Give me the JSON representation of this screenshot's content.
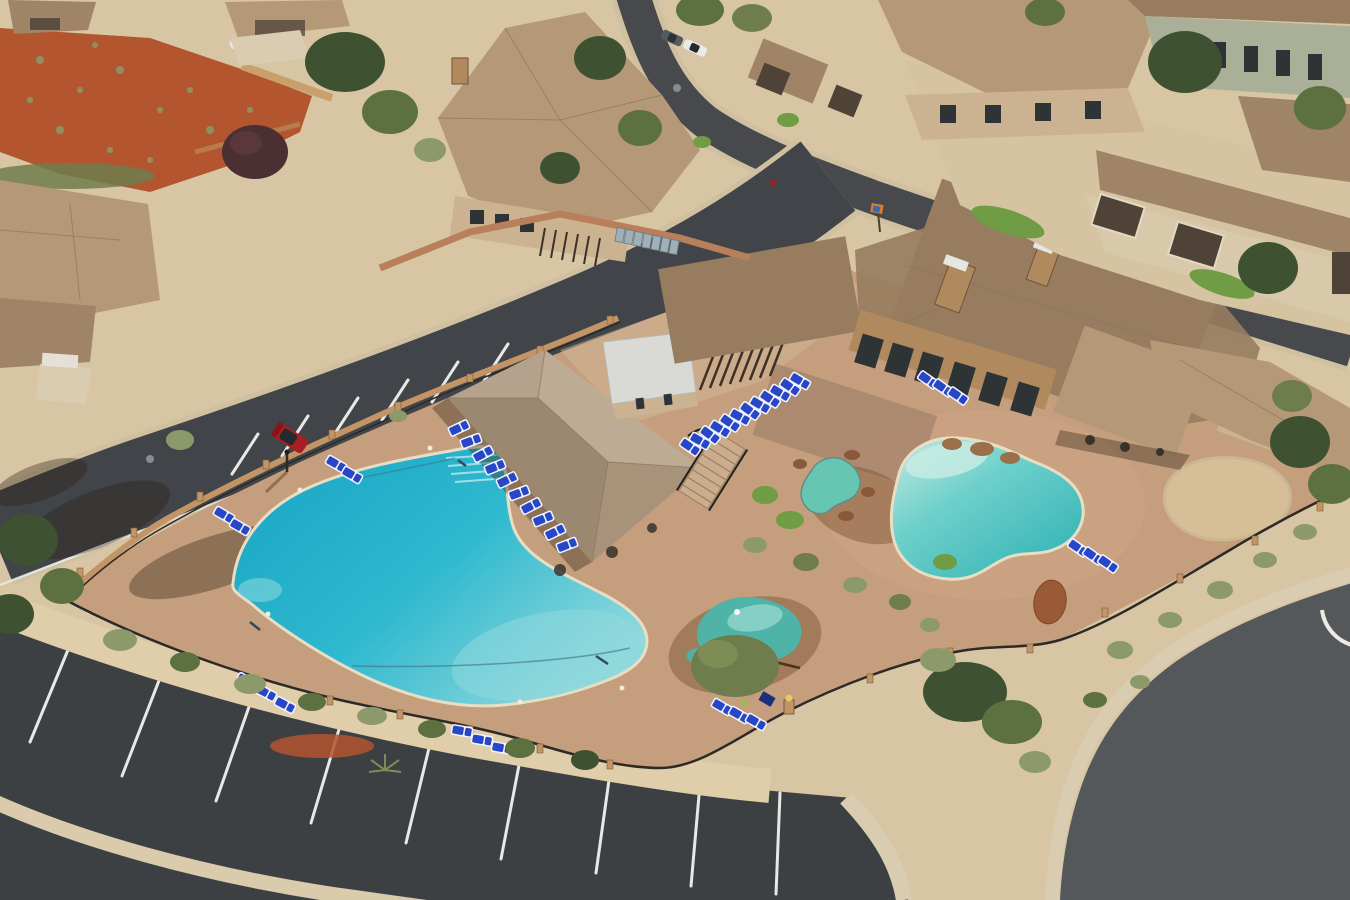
{
  "scene": {
    "title": "Aerial drone photo of a desert resort community pool area",
    "description": "Oblique aerial view of a southwest desert community clubhouse and pool complex: a large freeform turquoise swimming pool and pavilion at left, a lagoon-style pool with spa and teal rock splash feature at right, rows of blue lounge chairs, tan stucco clubhouse with stone chimneys, curved asphalt streets, striped parking lots, desert landscaping with sage shrubs, a red dirt hillside, and tile-roofed homes surrounding the amenity center.",
    "time_of_day": "midday, strong sun with shadows falling southwest",
    "environment": "red-rock desert residential community"
  },
  "objects": {
    "pools": [
      {
        "label": "main swimming pool",
        "shape": "large freeform kidney",
        "water": "turquoise, shallow end lighter at southeast"
      },
      {
        "label": "lagoon pool",
        "shape": "organic lagoon with beach entry",
        "water": "teal green"
      },
      {
        "label": "spa / hot tub",
        "shape": "small kidney",
        "water": "green-teal"
      },
      {
        "label": "splash rock water feature",
        "shape": "teal painted rock mound with wet deck"
      }
    ],
    "buildings": [
      {
        "label": "shade pavilion",
        "roof": "tan shingle hip roof"
      },
      {
        "label": "restroom / changing building",
        "roof": "white metal"
      },
      {
        "label": "pergola",
        "material": "dark wood slats"
      },
      {
        "label": "clubhouse",
        "roof": "brown shingle, two stone chimneys, tall glass wall, rear porch"
      },
      {
        "label": "surrounding homes",
        "count_visible": 10,
        "roof": "tan tile"
      }
    ],
    "lounge_chairs": {
      "total_approx": 40,
      "color": "blue sling with white frame",
      "groups": [
        "10 along pavilion west edge",
        "12 row from pavilion to pergola",
        "3 by clubhouse glass wall",
        "3 southeast of lagoon pool",
        "2 pairs on northwest deck",
        "3 on west deck",
        "3 on south deck",
        "3 near splash feature"
      ]
    },
    "vehicles": [
      {
        "type": "SUV",
        "color": "red",
        "location": "angled stall on pool access road"
      },
      {
        "type": "car",
        "color": "white",
        "location": "parked along upper street"
      },
      {
        "type": "SUV",
        "color": "dark gray",
        "location": "parked along upper street"
      },
      {
        "type": "car",
        "color": "white",
        "location": "driveway top left"
      }
    ],
    "roads": [
      "curved upper street",
      "pool access road with angled parking and crosswalk pavers",
      "striped crescent parking lot at bottom",
      "wide curved road at bottom right with white edge marking"
    ],
    "site_features": [
      "black wrought-iron pool fence with stone pillars",
      "retaining block walls",
      "sand play area",
      "green lawn circles",
      "desert gravel beds",
      "red dirt slope",
      "boulders",
      "stairway from clubhouse to pool deck",
      "utility bins along wall",
      "street sign",
      "manhole covers"
    ]
  },
  "colors": {
    "ground_desert": "#d8c5a3",
    "gravel_light": "#e0cdaa",
    "red_dirt": "#b3552f",
    "asphalt_parking": "#3d4043",
    "asphalt_street": "#47494c",
    "asphalt_road_big": "#55585b",
    "concrete_light": "#d9ccb0",
    "curb_light": "#cfc0a0",
    "deck_tan": "#c49e7d",
    "deck_light": "#d8bb9c",
    "deck_pink": "#cfa585",
    "roof_tan": "#b49878",
    "roof_tan_dark": "#a08468",
    "roof_brown": "#977c5f",
    "roof_white": "#d9d9d5",
    "wall_stucco": "#cbb291",
    "wall_green": "#a9b097",
    "wall_stone": "#b08a5e",
    "wall_brick": "#b97f5a",
    "garage_door": "#4f4236",
    "window_dark": "#2e3436",
    "pool_deep": "#17a3c4",
    "pool_mid": "#2fb9cf",
    "pool_shallow": "#8fd8dc",
    "lagoon_deep": "#2fb2b4",
    "lagoon_mid": "#6fd0cb",
    "lagoon_beach": "#c5ebe3",
    "spa_water": "#66c6b2",
    "splash_teal": "#4fb3a8",
    "splash_light": "#8fd4c9",
    "wet_brown": "#7a4f30",
    "lounger_blue": "#2746c8",
    "lounger_white": "#f2f4f8",
    "fence_dark": "#2c2a27",
    "pillar_stone": "#c39465",
    "stripe_white": "#e8e8e4",
    "tree_dark": "#3e5231",
    "tree_green": "#5d7040",
    "tree_sage": "#8c9a6b",
    "tree_olive": "#6f7d4c",
    "tree_purple": "#4a2f33",
    "grass_green": "#6f9c44",
    "car_red": "#a81e22",
    "car_glass": "#232a30",
    "sand": "#d6bf96",
    "rock_red": "#9b5a36",
    "bin_gray": "#9fb0b8",
    "sign_orange": "#e07b28",
    "sign_blue": "#2b6bc0",
    "shadow": "rgba(40,28,16,0.35)"
  }
}
